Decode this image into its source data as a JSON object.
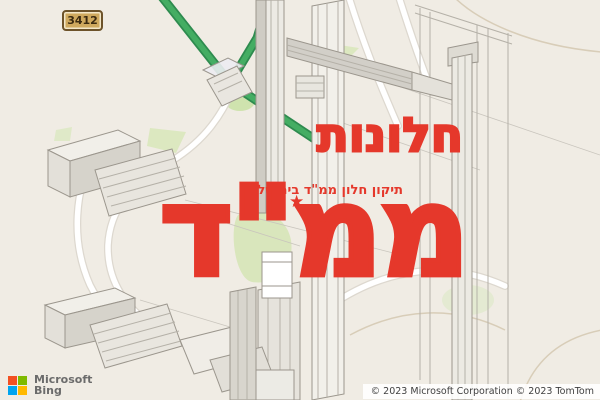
{
  "map": {
    "road_shield_label": "3412",
    "attribution": "© 2023 Microsoft Corporation © 2023 TomTom",
    "logo_line1": "Microsoft",
    "logo_line2": "Bing"
  },
  "overlay": {
    "title": "חלונות",
    "title_big": "ממ\"ד",
    "tagline": "תיקון חלון ממ\"ד בירושלים",
    "star_icon": "★",
    "text_color": "#e5382b"
  },
  "colors": {
    "map_background": "#f0ece4",
    "green_route": "#44ad63",
    "green_route_casing": "#2e8b4f",
    "park_green": "#dce8c0",
    "road_white": "#ffffff",
    "road_casing": "#ddd8cf",
    "cad_line": "#9b968d",
    "bing_red": "#f25022",
    "bing_green": "#7fba00",
    "bing_blue": "#00a4ef",
    "bing_yellow": "#ffb900"
  }
}
